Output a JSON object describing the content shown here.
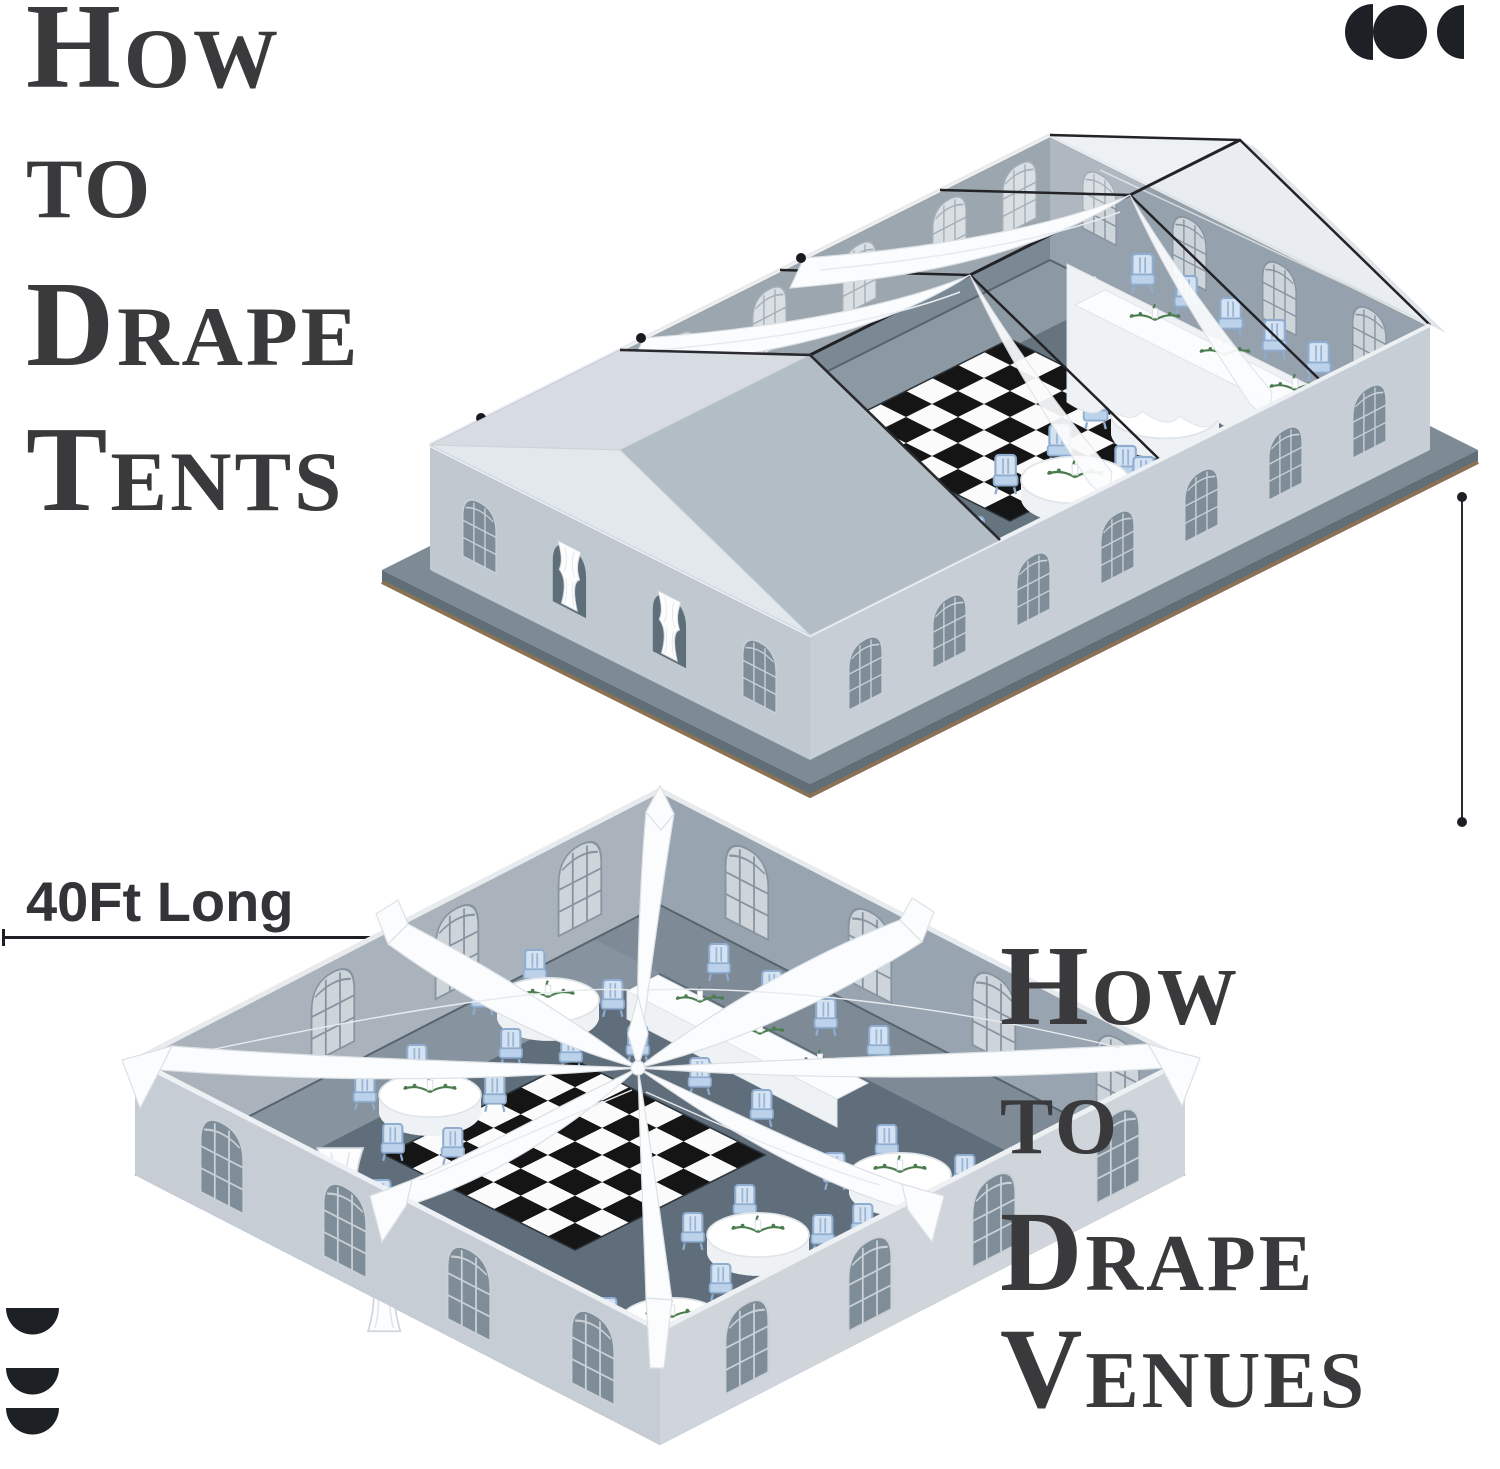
{
  "page": {
    "width": 1500,
    "height": 1469,
    "background": "#ffffff"
  },
  "headline_top": {
    "lines": [
      "How",
      "to",
      "Drape",
      "Tents"
    ]
  },
  "headline_bottom": {
    "lines": [
      "How",
      "to",
      "Drape",
      "Venues"
    ]
  },
  "measurement": {
    "horizontal_label": "40Ft Long"
  },
  "marks": {
    "top_right": "three-overlapping-circles-mark",
    "bottom_left": "three-half-discs-mark"
  },
  "illustrations": {
    "top": "draped-frame-tent-isometric",
    "bottom": "draped-venue-isometric"
  },
  "palette": {
    "headline_text": "#3a3a3c",
    "measurement_text": "#333338",
    "measurement_line": "#1f1f23",
    "mark_black": "#1d2025",
    "drape_white": "#fbfcfd",
    "chair_blue": "#d5e2f2",
    "checker_black": "#151515",
    "checker_white": "#fbfbfb",
    "greenery_green": "#4a7c4e",
    "wall_light_gray": "#c6cdd4",
    "wall_inner_gray": "#7a8994",
    "floor_slate": "#66747f",
    "platform_gray": "#7d8b94",
    "platform_edge_brown": "#8a7257"
  }
}
